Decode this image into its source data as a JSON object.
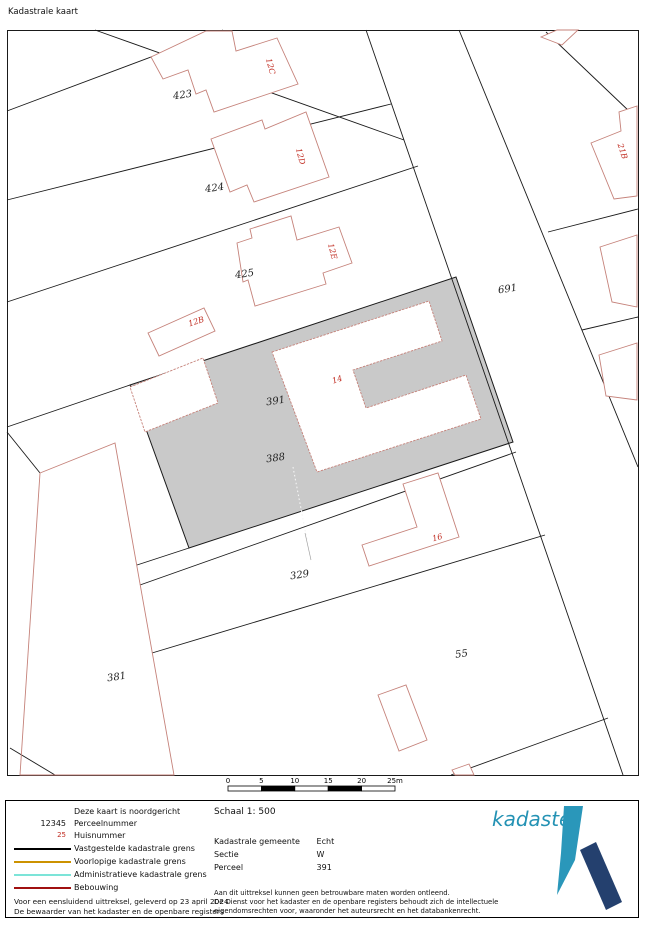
{
  "title": "Kadastrale kaart",
  "colors": {
    "line": "#1a1a1a",
    "gray": "#c9c9c9",
    "building": "#c5827a",
    "red_label": "#c02b20",
    "legend_black": "#000000",
    "legend_orange": "#cc9200",
    "legend_cyan": "#7ce4d8",
    "legend_darkred": "#a01010",
    "logo_text": "#2492b4",
    "logo_pen": "#2a97ba",
    "logo_bar": "#24406e"
  },
  "map": {
    "frame": {
      "x": 7.5,
      "y": 30.5,
      "w": 631,
      "h": 745
    },
    "gray_parcel": "130,385 456,277 513,442 189,548",
    "holes": [
      {
        "name": "building-14-footprint",
        "points": "272,352 429,301 442,341 353,370 366,408 466,375 481,419 317,472"
      },
      {
        "name": "building-in-391-footprint",
        "points": "130,387 203,358 218,403 145,432"
      }
    ],
    "dotted_divider": {
      "x1": 293,
      "y1": 467,
      "x2": 307,
      "y2": 540
    },
    "divider_tail": {
      "x1": 305,
      "y1": 533,
      "x2": 311,
      "y2": 560
    },
    "lines": [
      {
        "name": "boundary-topleft-a",
        "p": [
          7,
          111,
          223,
          30
        ]
      },
      {
        "name": "boundary-topleft-b",
        "p": [
          95,
          30,
          404,
          140
        ]
      },
      {
        "name": "boundary-423-424",
        "p": [
          7,
          200,
          391,
          104
        ]
      },
      {
        "name": "boundary-424-425",
        "p": [
          7,
          302,
          418,
          166
        ]
      },
      {
        "name": "boundary-425-391-stub",
        "p": [
          7,
          427,
          130,
          385
        ]
      },
      {
        "name": "boundary-west-a",
        "p": [
          7,
          432,
          40,
          473
        ]
      },
      {
        "name": "boundary-west-b",
        "p": [
          10,
          748,
          55,
          775
        ]
      },
      {
        "name": "boundary-391-stub",
        "p": [
          137,
          565,
          189,
          548
        ]
      },
      {
        "name": "boundary-388-329",
        "p": [
          140,
          585,
          516,
          452
        ]
      },
      {
        "name": "boundary-329-55",
        "p": [
          152,
          653,
          545,
          535
        ]
      },
      {
        "name": "boundary-55-south",
        "p": [
          451,
          775,
          608,
          718
        ]
      },
      {
        "name": "road-left-edge",
        "p": [
          366,
          30,
          623,
          775
        ]
      },
      {
        "name": "road-right-edge",
        "p": [
          459,
          30,
          638,
          467
        ]
      },
      {
        "name": "boundary-topright-oblique",
        "p": [
          546,
          32,
          630,
          112
        ]
      },
      {
        "name": "boundary-21b-north",
        "p": [
          548,
          232,
          638,
          209
        ]
      },
      {
        "name": "boundary-21b-south",
        "p": [
          582,
          330,
          638,
          317
        ]
      }
    ],
    "pink_parcels": [
      {
        "name": "parcel-381-outline",
        "points": "40,473 115,443 174,775 20,775"
      }
    ],
    "buildings": [
      {
        "name": "building-12c",
        "points": "151,57 206,31 232,31 236,51 277,38 298,84 214,112 206,90 196,94 188,70 163,79"
      },
      {
        "name": "building-12d",
        "points": "211,139 262,120 265,129 306,112 329,177 254,202 247,185 230,192"
      },
      {
        "name": "building-12e",
        "points": "237,243 252,238 250,229 291,216 297,240 339,227 352,263 323,273 326,284 255,306 248,280 243,282"
      },
      {
        "name": "building-12b",
        "points": "148,333 204,308 215,331 159,356"
      },
      {
        "name": "building-top-corner",
        "points": "541,37 557,30 578,30 562,45"
      },
      {
        "name": "building-21b",
        "points": "591,143 621,131 619,112 637,106 637,196 614,199"
      },
      {
        "name": "building-right-mid",
        "points": "600,247 637,235 637,307 612,302"
      },
      {
        "name": "building-right-low",
        "points": "599,355 637,343 637,400 606,396"
      },
      {
        "name": "building-16",
        "points": "362,545 417,527 403,484 438,473 459,537 369,566"
      },
      {
        "name": "building-in-55",
        "points": "378,695 406,685 427,740 399,751"
      },
      {
        "name": "building-bottom-clipped",
        "points": "452,770 469,764 474,775 455,775"
      }
    ],
    "labels": [
      {
        "t": "423",
        "x": 183,
        "y": 98,
        "r": -8,
        "kind": "parcel"
      },
      {
        "t": "424",
        "x": 215,
        "y": 191,
        "r": -8,
        "kind": "parcel"
      },
      {
        "t": "425",
        "x": 245,
        "y": 277,
        "r": -8,
        "kind": "parcel"
      },
      {
        "t": "691",
        "x": 508,
        "y": 292,
        "r": -8,
        "kind": "parcel"
      },
      {
        "t": "391",
        "x": 276,
        "y": 404,
        "r": -8,
        "kind": "parcel"
      },
      {
        "t": "388",
        "x": 276,
        "y": 461,
        "r": -8,
        "kind": "parcel"
      },
      {
        "t": "329",
        "x": 300,
        "y": 578,
        "r": -8,
        "kind": "parcel"
      },
      {
        "t": "55",
        "x": 462,
        "y": 657,
        "r": -8,
        "kind": "parcel"
      },
      {
        "t": "381",
        "x": 117,
        "y": 680,
        "r": -8,
        "kind": "parcel"
      },
      {
        "t": "12C",
        "x": 268,
        "y": 67,
        "r": 75,
        "kind": "house"
      },
      {
        "t": "12D",
        "x": 298,
        "y": 157,
        "r": 75,
        "kind": "house"
      },
      {
        "t": "12E",
        "x": 330,
        "y": 252,
        "r": 75,
        "kind": "house"
      },
      {
        "t": "21B",
        "x": 620,
        "y": 152,
        "r": 72,
        "kind": "house"
      },
      {
        "t": "12B",
        "x": 197,
        "y": 324,
        "r": -18,
        "kind": "house"
      },
      {
        "t": "14",
        "x": 338,
        "y": 382,
        "r": -18,
        "kind": "house"
      },
      {
        "t": "16",
        "x": 438,
        "y": 540,
        "r": -15,
        "kind": "house"
      }
    ],
    "scalebar": {
      "ticks": [
        "0",
        "5",
        "10",
        "15",
        "20",
        "25m"
      ],
      "x": 228,
      "y": 786,
      "w": 167,
      "h": 5,
      "label_y": 783
    }
  },
  "legend": {
    "north_note": "Deze kaart is noordgericht",
    "parcel_sample": "12345",
    "parcel_label": "Perceelnummer",
    "house_sample": "25",
    "house_label": "Huisnummer",
    "line1_label": "Vastgestelde kadastrale grens",
    "line2_label": "Voorlopige kadastrale grens",
    "line3_label": "Administratieve kadastrale grens",
    "line4_label": "Bebouwing",
    "footer1": "Voor een eensluidend uittreksel, geleverd op 23 april 2024",
    "footer2": "De bewaarder van het kadaster en de openbare registers"
  },
  "info": {
    "scale": "Schaal 1: 500",
    "fields": [
      {
        "label": "Kadastrale gemeente",
        "value": "Echt"
      },
      {
        "label": "Sectie",
        "value": "W"
      },
      {
        "label": "Perceel",
        "value": "391"
      }
    ],
    "disclaimer1": "Aan dit uittreksel kunnen geen betrouwbare maten worden ontleend.",
    "disclaimer2": "De Dienst voor het kadaster en de openbare registers behoudt zich de intellectuele",
    "disclaimer3": "eigendomsrechten voor, waaronder het auteursrecht en het databankenrecht."
  },
  "logo": {
    "text": "kadaster"
  }
}
